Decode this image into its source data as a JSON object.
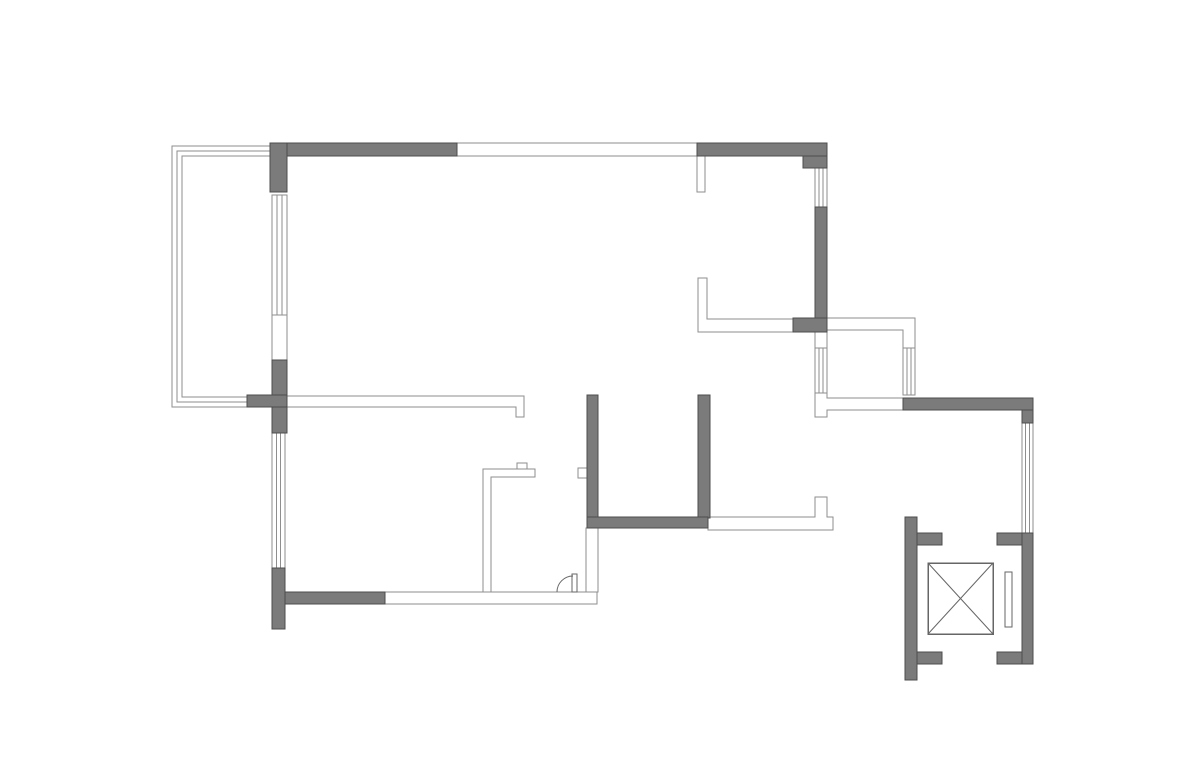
{
  "canvas": {
    "width": 1200,
    "height": 776,
    "background": "#ffffff"
  },
  "palette": {
    "solid_wall_fill": "#7b7b7b",
    "solid_wall_stroke": "#4d4d4d",
    "thin_wall_stroke": "#8e8e8e",
    "thin_wall_fill": "#ffffff",
    "window_stroke": "#8e8e8e",
    "fixture_stroke": "#666666"
  },
  "floorplan": {
    "solid_walls": [
      {
        "id": "exterior-wall-top-left",
        "x": 270,
        "y": 143,
        "w": 187,
        "h": 13
      },
      {
        "id": "exterior-wall-top-right",
        "x": 697,
        "y": 143,
        "w": 130,
        "h": 13
      },
      {
        "id": "corner-step-top-right",
        "x": 803,
        "y": 156,
        "w": 24,
        "h": 12
      },
      {
        "id": "exterior-wall-right-upper",
        "x": 815,
        "y": 207,
        "w": 12,
        "h": 111
      },
      {
        "id": "corner-block-right",
        "x": 793,
        "y": 318,
        "w": 34,
        "h": 14
      },
      {
        "id": "left-wall-top-block",
        "x": 270,
        "y": 143,
        "w": 17,
        "h": 49
      },
      {
        "id": "left-wall-mid-block",
        "x": 272,
        "y": 360,
        "w": 15,
        "h": 73
      },
      {
        "id": "balcony-tee-bar",
        "x": 247,
        "y": 395,
        "w": 40,
        "h": 12
      },
      {
        "id": "left-wall-lower-block",
        "x": 272,
        "y": 568,
        "w": 13,
        "h": 61
      },
      {
        "id": "bottom-wall-dark",
        "x": 285,
        "y": 592,
        "w": 100,
        "h": 12
      },
      {
        "id": "interior-wall-vertical-left",
        "x": 587,
        "y": 395,
        "w": 11,
        "h": 133
      },
      {
        "id": "interior-wall-vertical-right",
        "x": 698,
        "y": 395,
        "w": 12,
        "h": 123
      },
      {
        "id": "interior-wall-horizontal",
        "x": 587,
        "y": 517,
        "w": 121,
        "h": 11
      },
      {
        "id": "hall-wall-top",
        "x": 903,
        "y": 398,
        "w": 130,
        "h": 12
      },
      {
        "id": "hall-wall-right-upper",
        "x": 1022,
        "y": 410,
        "w": 11,
        "h": 13
      },
      {
        "id": "elevator-right-column",
        "x": 1022,
        "y": 533,
        "w": 11,
        "h": 131
      },
      {
        "id": "elevator-right-arm-top",
        "x": 997,
        "y": 533,
        "w": 25,
        "h": 12
      },
      {
        "id": "elevator-right-arm-bottom",
        "x": 997,
        "y": 652,
        "w": 25,
        "h": 12
      },
      {
        "id": "elevator-left-column",
        "x": 905,
        "y": 517,
        "w": 12,
        "h": 163
      },
      {
        "id": "elevator-left-arm-top",
        "x": 917,
        "y": 533,
        "w": 25,
        "h": 12
      },
      {
        "id": "elevator-left-arm-bottom",
        "x": 917,
        "y": 652,
        "w": 25,
        "h": 12
      }
    ],
    "thin_wall_rects": [
      {
        "id": "top-window-band",
        "x": 457,
        "y": 143,
        "w": 240,
        "h": 13
      },
      {
        "id": "top-wall-stub",
        "x": 697,
        "y": 156,
        "w": 8,
        "h": 36
      },
      {
        "id": "bay-left-upper-segment",
        "x": 815,
        "y": 332,
        "w": 12,
        "h": 16
      },
      {
        "id": "wall-stub-kitchen-east",
        "x": 578,
        "y": 468,
        "w": 9,
        "h": 10
      },
      {
        "id": "kitchen-counter-bump",
        "x": 517,
        "y": 463,
        "w": 10,
        "h": 6
      },
      {
        "id": "bottom-wall-thin",
        "x": 385,
        "y": 592,
        "w": 212,
        "h": 12
      },
      {
        "id": "below-wall-thin-vertical",
        "x": 586,
        "y": 528,
        "w": 12,
        "h": 64
      }
    ],
    "thin_wall_polygons": [
      {
        "id": "interior-long-wall",
        "points": "287,396 524,396 524,417 516,417 516,407 287,407"
      },
      {
        "id": "kitchen-partition-L",
        "points": "483,469 535,469 535,477 491,477 491,592 483,592"
      },
      {
        "id": "closet-wall-C",
        "points": "698,278 707,278 707,319 793,319 793,332 698,332"
      },
      {
        "id": "bay-top-band",
        "points": "825,318 915,318 915,348 903,348 903,330 825,330"
      },
      {
        "id": "bay-bottom-band",
        "points": "815,393 827,393 827,398 903,398 903,410 827,410 827,417 815,417"
      },
      {
        "id": "bedroom-bottom-band",
        "points": "708,517 815,517 815,497 827,497 827,517 833,517 833,530 708,530"
      }
    ],
    "windows": [
      {
        "id": "window-left-upper",
        "x": 272,
        "y": 195,
        "w": 15,
        "h": 120,
        "dir": "v"
      },
      {
        "id": "window-left-lower",
        "x": 272,
        "y": 433,
        "w": 13,
        "h": 135,
        "dir": "v"
      },
      {
        "id": "window-right-top",
        "x": 815,
        "y": 168,
        "w": 12,
        "h": 39,
        "dir": "v"
      },
      {
        "id": "window-bay-left",
        "x": 815,
        "y": 348,
        "w": 12,
        "h": 45,
        "dir": "v"
      },
      {
        "id": "window-bay-right",
        "x": 903,
        "y": 348,
        "w": 12,
        "h": 47,
        "dir": "v"
      },
      {
        "id": "window-hall-right",
        "x": 1022,
        "y": 423,
        "w": 11,
        "h": 110,
        "dir": "v"
      }
    ],
    "opening_lines": [
      {
        "id": "balcony-door-jamb-left",
        "x1": 272,
        "y1": 315,
        "x2": 272,
        "y2": 360
      },
      {
        "id": "balcony-door-jamb-right",
        "x1": 287,
        "y1": 315,
        "x2": 287,
        "y2": 360
      }
    ],
    "railing": {
      "id": "balcony-railing",
      "line_count": 3,
      "spacing": 5,
      "left_x": 172,
      "top_y": 146,
      "bottom_y": 407,
      "top_end_x": 270,
      "bottom_end_x": 247
    },
    "door_swing": {
      "id": "entry-door",
      "leaf": {
        "x": 572,
        "y": 574,
        "w": 5,
        "h": 18
      },
      "arc_path": "M 557 592 A 16 16 0 0 1 573 576"
    },
    "elevator": {
      "car": {
        "id": "elevator-car",
        "x": 928,
        "y": 563,
        "w": 65,
        "h": 71
      },
      "door": {
        "id": "elevator-door",
        "x": 1005,
        "y": 572,
        "w": 7,
        "h": 55
      }
    }
  }
}
